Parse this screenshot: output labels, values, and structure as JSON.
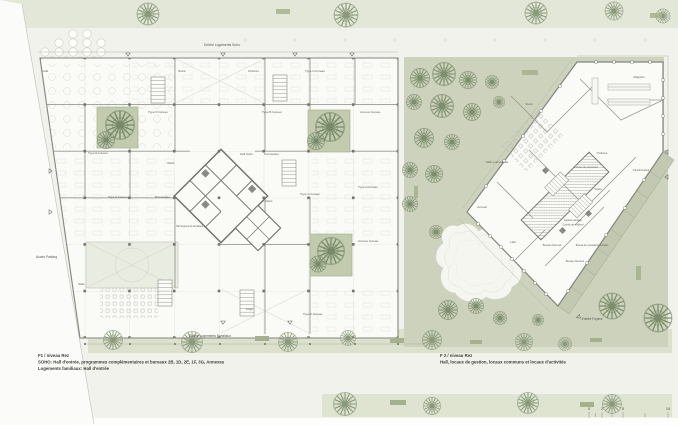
{
  "site": {
    "labels": {
      "entree_soho": "Entrée Logements Soho",
      "entree_familiaux": "Entrée Logements Familiaux",
      "entree_foyers": "Entrée Foyers",
      "acces_parking": "Accès Parking"
    },
    "captions": {
      "f1_line1": "F1 / niveau Rez",
      "f1_line2": "SOHO: Hall d'entrée, programmes complémentaires et bureaux 2B, 1D, 2E, 1F, 3G, Annexes",
      "f1_line3": "Logements familiaux: Hall d'entrée",
      "f2_line1": "F 2 / niveau Rez",
      "f2_line2": "Hall, locaux de gestion, locaux communs et locaux d'activités"
    },
    "scale_bar": [
      "0",
      "2",
      "5",
      "10"
    ],
    "colors": {
      "strip_green": "#e3e7d7",
      "lawn_green": "#ccd2bc",
      "courtyard_green": "#c2cbae",
      "band_green": "#dce1ce",
      "wall_gray": "#8b8b86",
      "label_gray": "#5f5f58"
    }
  },
  "left_building": {
    "rooms": [
      "Café",
      "Stock",
      "Ordures",
      "Type G bureau",
      "Type D bureau",
      "Type B bureau",
      "Annexe bureau",
      "Type E bureau",
      "Vélos",
      "Hall Soho",
      "Poussettes",
      "Type G bureau",
      "Type E bureau",
      "Poussettes",
      "Vélos",
      "Type G bureau",
      "Hall logements familiaux",
      "Annexe bureau",
      "Salle",
      "Loge",
      "Type F bureau"
    ]
  },
  "right_building": {
    "rooms": [
      "Magasin",
      "Stock",
      "Salle polyvalente",
      "Ordures",
      "Locaux du personnel",
      "Transformateur",
      "Vélos",
      "Accueil",
      "Hall",
      "Espace partagé",
      "Comité de résident",
      "Bureau d'accueil",
      "Bureau des prestations sociales",
      "Bureau directeur"
    ]
  }
}
